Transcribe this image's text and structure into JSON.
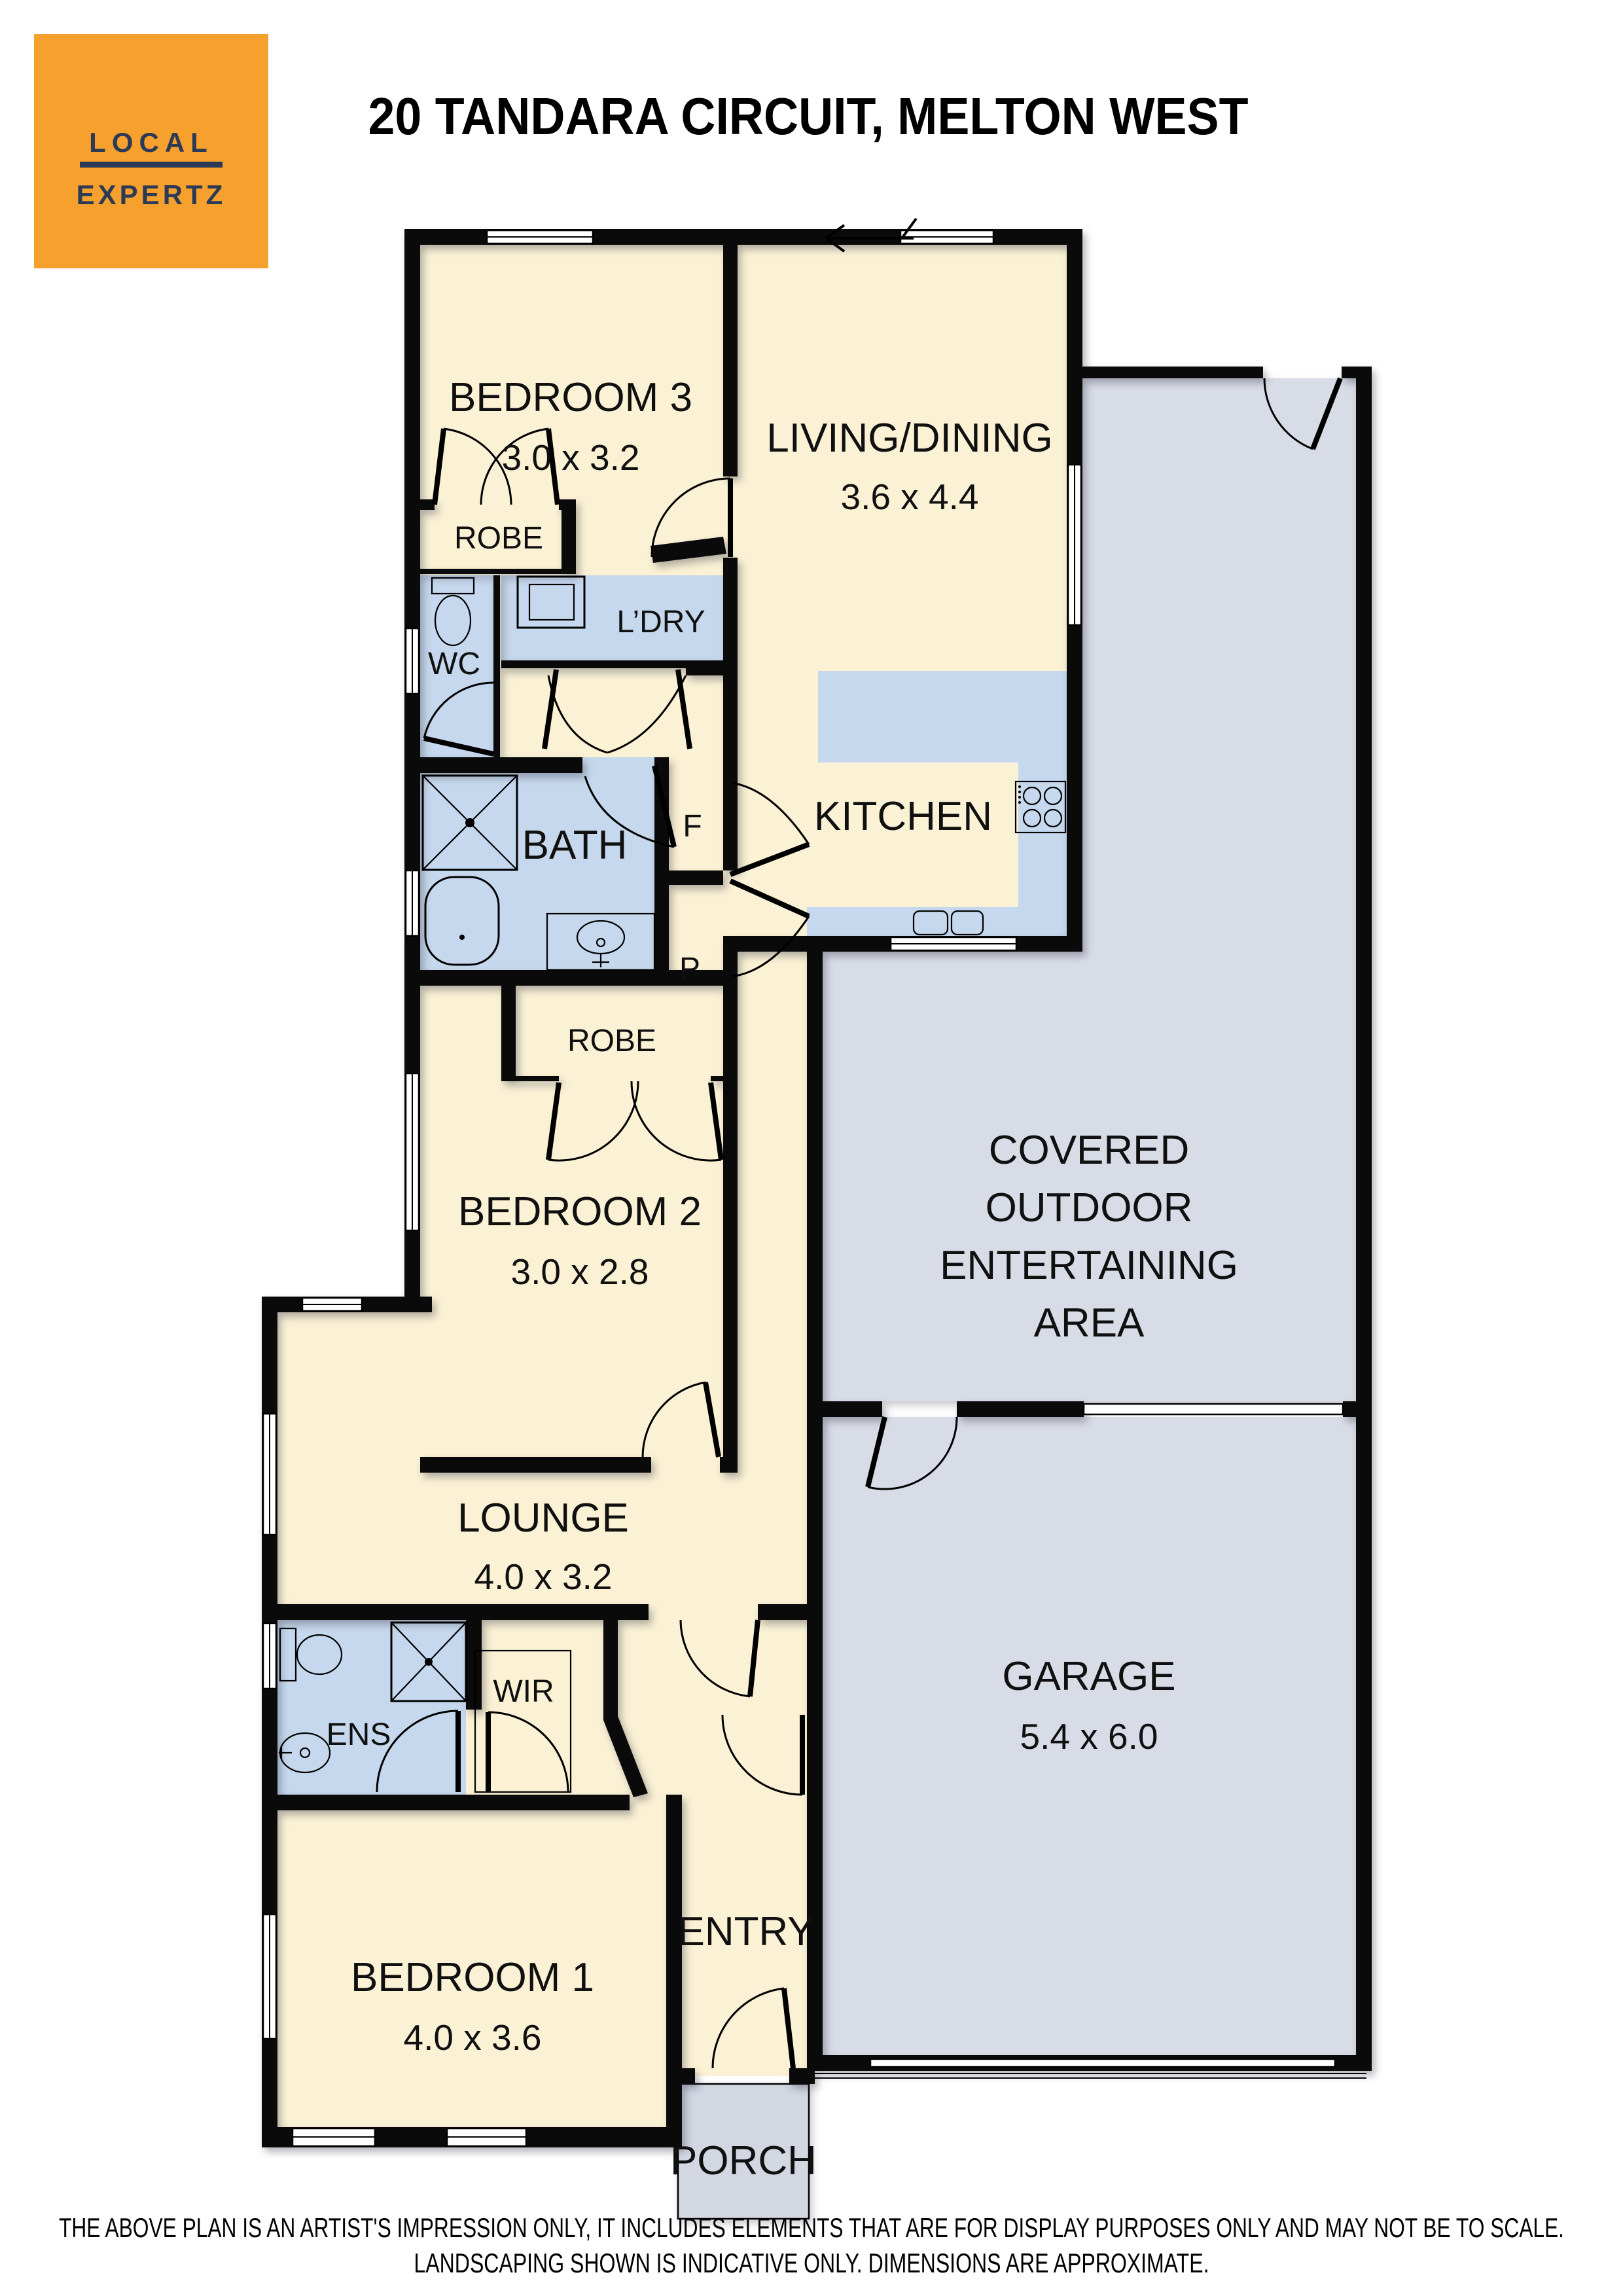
{
  "logo": {
    "line1": "LOCAL",
    "line2": "EXPERTZ"
  },
  "header": {
    "title": "20 TANDARA CIRCUIT, MELTON WEST"
  },
  "rooms": {
    "bedroom3": {
      "name": "BEDROOM 3",
      "dims": "3.0 x 3.2"
    },
    "living": {
      "name": "LIVING/DINING",
      "dims": "3.6 x 4.4"
    },
    "kitchen": {
      "name": "KITCHEN"
    },
    "bath": {
      "name": "BATH"
    },
    "bedroom2": {
      "name": "BEDROOM 2",
      "dims": "3.0 x 2.8"
    },
    "outdoor": {
      "line1": "COVERED",
      "line2": "OUTDOOR",
      "line3": "ENTERTAINING",
      "line4": "AREA"
    },
    "lounge": {
      "name": "LOUNGE",
      "dims": "4.0 x 3.2"
    },
    "garage": {
      "name": "GARAGE",
      "dims": "5.4 x 6.0"
    },
    "bedroom1": {
      "name": "BEDROOM 1",
      "dims": "4.0 x 3.6"
    },
    "entry": {
      "name": "ENTRY"
    },
    "porch": {
      "name": "PORCH"
    }
  },
  "labels": {
    "robe_bed3": "ROBE",
    "robe_bed2": "ROBE",
    "wc": "WC",
    "laundry": "L’DRY",
    "fridge": "F",
    "pantry": "P",
    "ensuite": "ENS",
    "wardrobe": "WIR"
  },
  "footer": {
    "line1": "THE ABOVE PLAN IS AN ARTIST'S IMPRESSION ONLY, IT INCLUDES ELEMENTS THAT ARE FOR DISPLAY PURPOSES ONLY AND MAY NOT BE TO SCALE.",
    "line2": "LANDSCAPING SHOWN IS INDICATIVE ONLY. DIMENSIONS ARE APPROXIMATE."
  },
  "colors": {
    "floor_cream": "#FBF2D5",
    "wet_area_blue": "#C6D8ED",
    "outdoor_gray": "#D8DCE6",
    "porch_gray": "#D2D7E2",
    "wall_black": "#0A0A0A",
    "logo_orange": "#F6A12E",
    "logo_navy": "#2D3A56"
  }
}
